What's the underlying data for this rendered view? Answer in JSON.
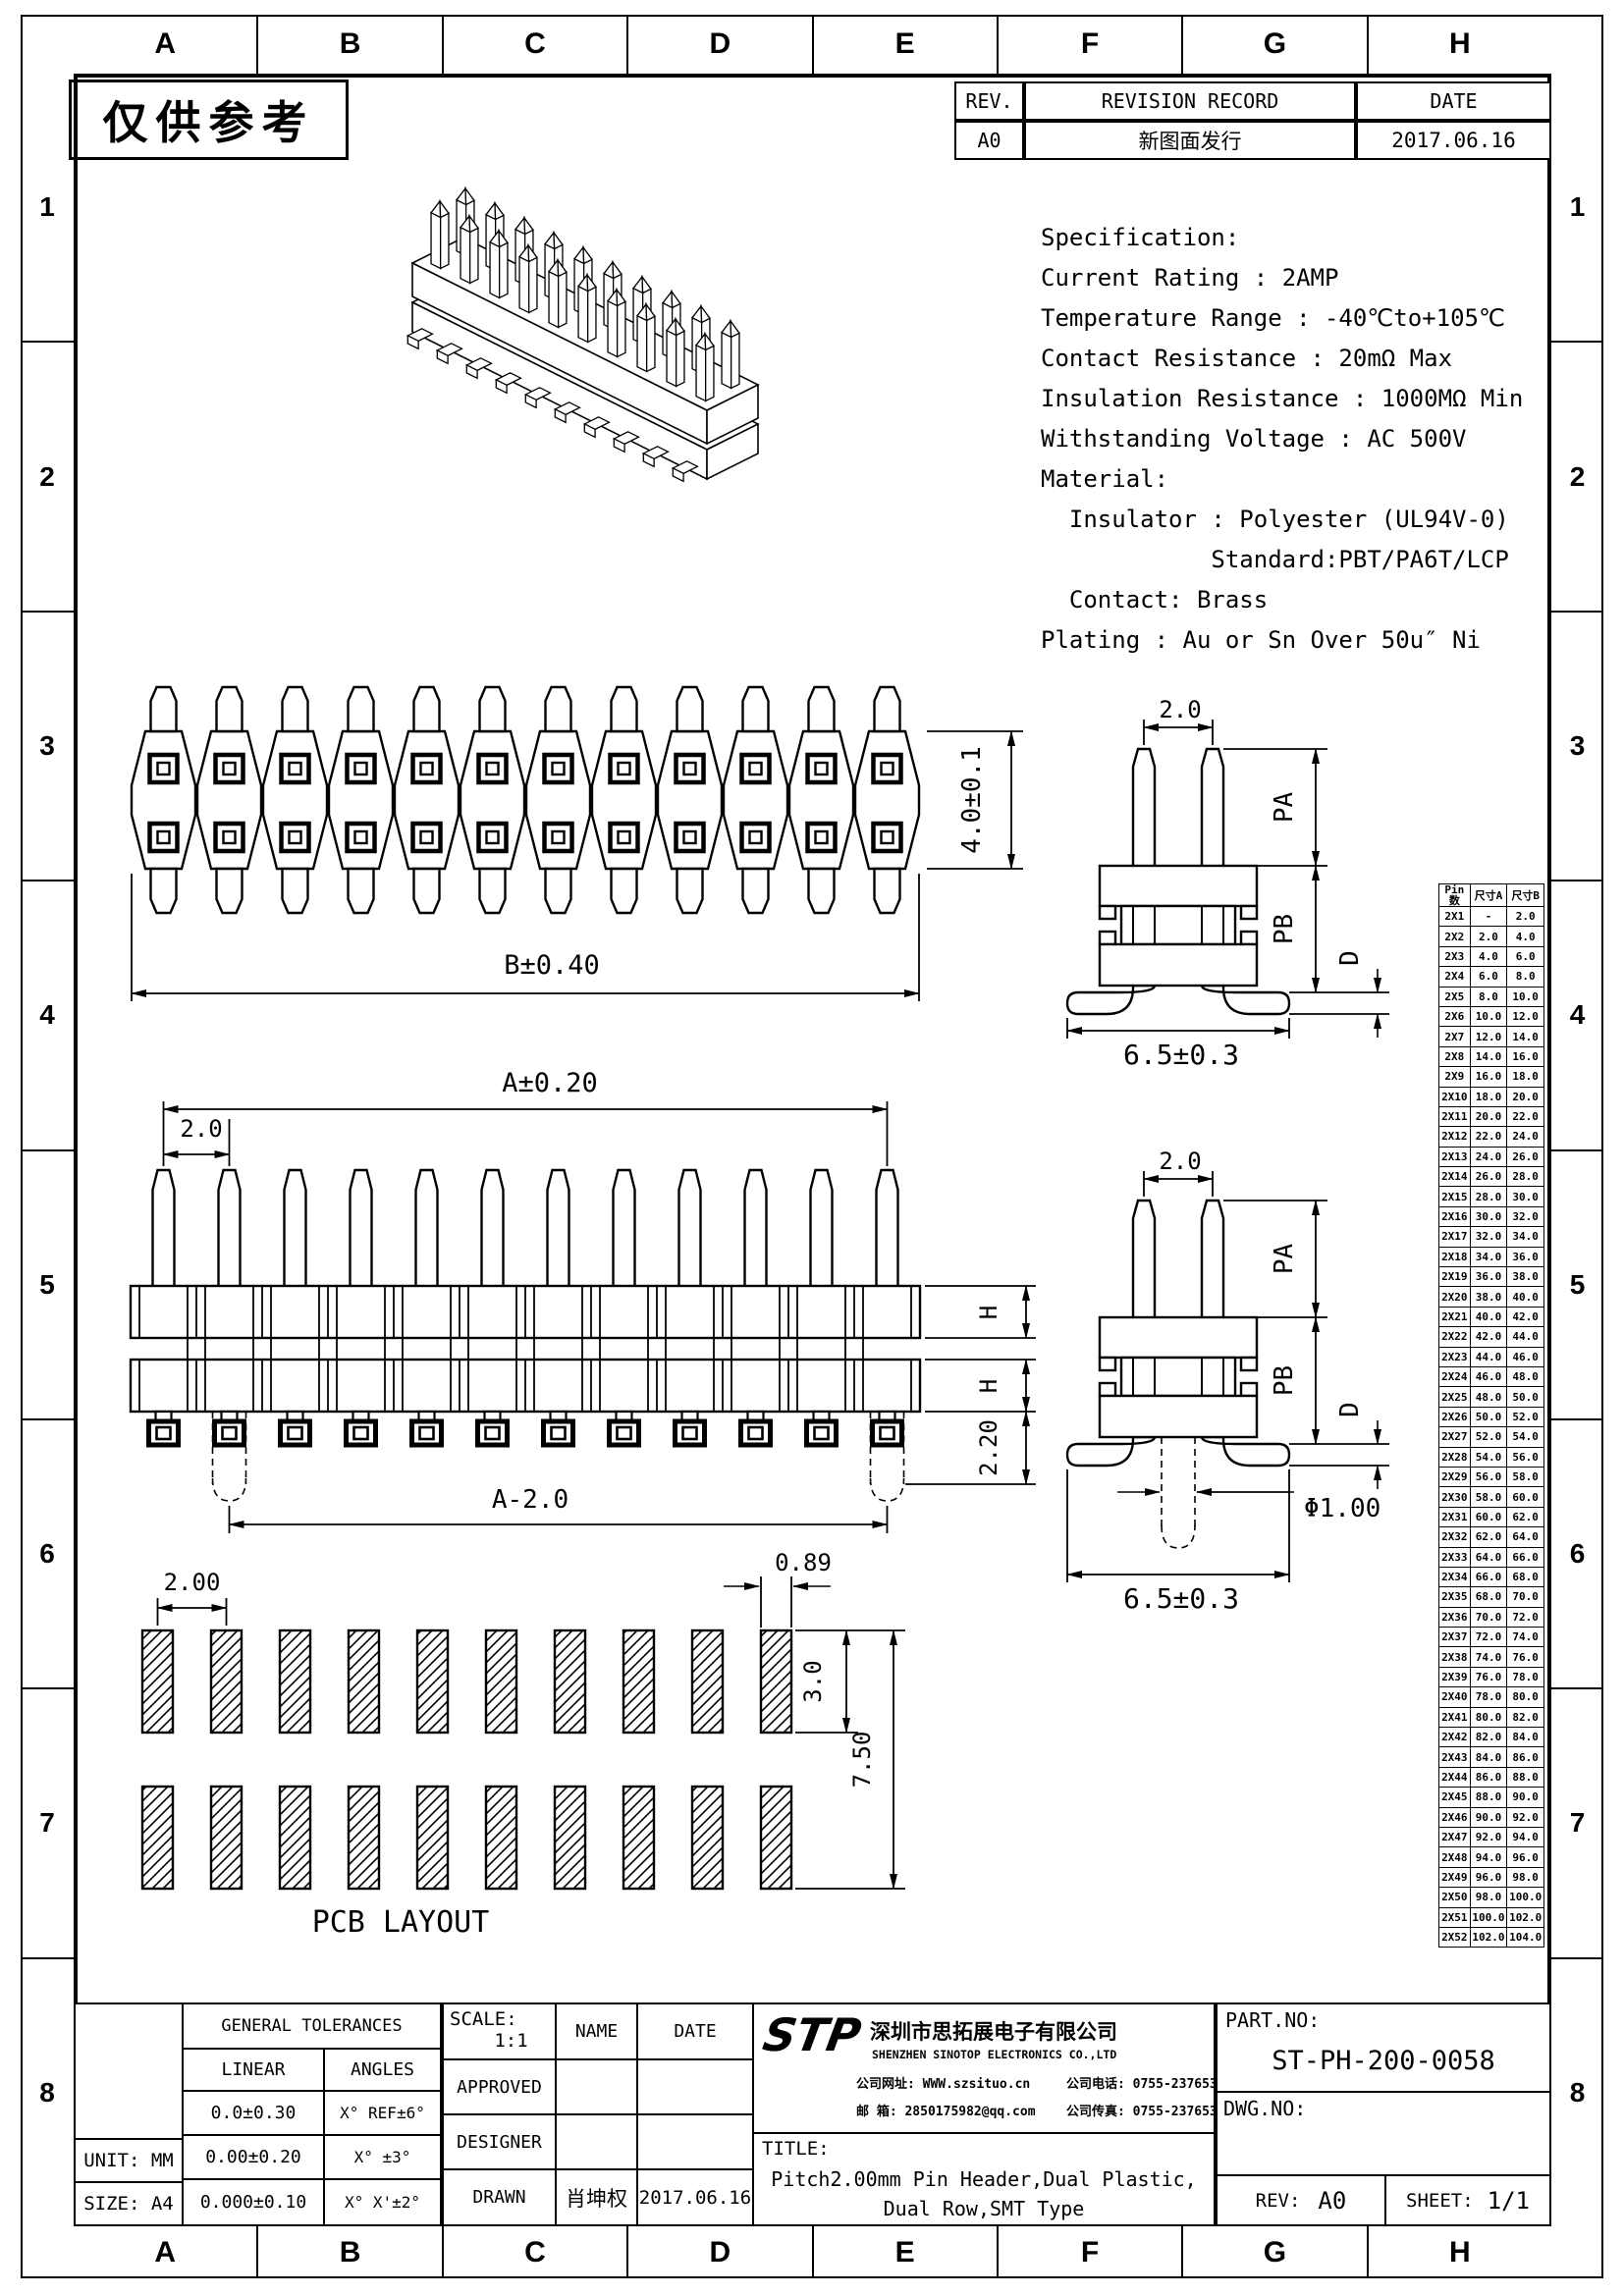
{
  "sheet": {
    "grid_letters": [
      "A",
      "B",
      "C",
      "D",
      "E",
      "F",
      "G",
      "H"
    ],
    "grid_numbers": [
      "1",
      "2",
      "3",
      "4",
      "5",
      "6",
      "7",
      "8"
    ],
    "stamp": "仅供参考"
  },
  "revision_table": {
    "headers": [
      "REV.",
      "REVISION RECORD",
      "DATE"
    ],
    "rows": [
      [
        "A0",
        "新图面发行",
        "2017.06.16"
      ]
    ]
  },
  "specification": {
    "lines": [
      "Specification:",
      "Current Rating : 2AMP",
      "Temperature Range : -40℃to+105℃",
      "Contact Resistance : 20mΩ Max",
      "Insulation Resistance : 1000MΩ Min",
      "Withstanding Voltage : AC 500V",
      "Material:",
      "  Insulator : Polyester (UL94V-0)",
      "            Standard:PBT/PA6T/LCP",
      "  Contact: Brass",
      "Plating : Au or Sn Over 50u″ Ni"
    ]
  },
  "views": {
    "top_view": {
      "pin_columns": 12,
      "dim_length": "B±0.40",
      "dim_height": "4.0±0.1"
    },
    "front_view": {
      "pin_columns": 12,
      "dim_overall": "A±0.20",
      "dim_pitch": "2.0",
      "dim_body_h": "H",
      "dim_foot": "2.20",
      "dim_peg_span": "A-2.0"
    },
    "side_view_upper": {
      "dim_pitch": "2.0",
      "dim_pa": "PA",
      "dim_pb": "PB",
      "dim_d": "D",
      "dim_width": "6.5±0.3"
    },
    "side_view_lower": {
      "dim_pitch": "2.0",
      "dim_pa": "PA",
      "dim_pb": "PB",
      "dim_d": "D",
      "dim_width": "6.5±0.3",
      "dim_peg_dia": "Φ1.00"
    },
    "pcb_layout": {
      "pads_per_row": 10,
      "rows": 2,
      "dim_pitch": "2.00",
      "dim_pad_w": "0.89",
      "dim_pad_h": "3.0",
      "dim_span": "7.50",
      "label": "PCB LAYOUT"
    }
  },
  "size_table": {
    "headers": [
      "Pin数",
      "尺寸A",
      "尺寸B"
    ],
    "rows": [
      [
        "2X1",
        "-",
        "2.0"
      ],
      [
        "2X2",
        "2.0",
        "4.0"
      ],
      [
        "2X3",
        "4.0",
        "6.0"
      ],
      [
        "2X4",
        "6.0",
        "8.0"
      ],
      [
        "2X5",
        "8.0",
        "10.0"
      ],
      [
        "2X6",
        "10.0",
        "12.0"
      ],
      [
        "2X7",
        "12.0",
        "14.0"
      ],
      [
        "2X8",
        "14.0",
        "16.0"
      ],
      [
        "2X9",
        "16.0",
        "18.0"
      ],
      [
        "2X10",
        "18.0",
        "20.0"
      ],
      [
        "2X11",
        "20.0",
        "22.0"
      ],
      [
        "2X12",
        "22.0",
        "24.0"
      ],
      [
        "2X13",
        "24.0",
        "26.0"
      ],
      [
        "2X14",
        "26.0",
        "28.0"
      ],
      [
        "2X15",
        "28.0",
        "30.0"
      ],
      [
        "2X16",
        "30.0",
        "32.0"
      ],
      [
        "2X17",
        "32.0",
        "34.0"
      ],
      [
        "2X18",
        "34.0",
        "36.0"
      ],
      [
        "2X19",
        "36.0",
        "38.0"
      ],
      [
        "2X20",
        "38.0",
        "40.0"
      ],
      [
        "2X21",
        "40.0",
        "42.0"
      ],
      [
        "2X22",
        "42.0",
        "44.0"
      ],
      [
        "2X23",
        "44.0",
        "46.0"
      ],
      [
        "2X24",
        "46.0",
        "48.0"
      ],
      [
        "2X25",
        "48.0",
        "50.0"
      ],
      [
        "2X26",
        "50.0",
        "52.0"
      ],
      [
        "2X27",
        "52.0",
        "54.0"
      ],
      [
        "2X28",
        "54.0",
        "56.0"
      ],
      [
        "2X29",
        "56.0",
        "58.0"
      ],
      [
        "2X30",
        "58.0",
        "60.0"
      ],
      [
        "2X31",
        "60.0",
        "62.0"
      ],
      [
        "2X32",
        "62.0",
        "64.0"
      ],
      [
        "2X33",
        "64.0",
        "66.0"
      ],
      [
        "2X34",
        "66.0",
        "68.0"
      ],
      [
        "2X35",
        "68.0",
        "70.0"
      ],
      [
        "2X36",
        "70.0",
        "72.0"
      ],
      [
        "2X37",
        "72.0",
        "74.0"
      ],
      [
        "2X38",
        "74.0",
        "76.0"
      ],
      [
        "2X39",
        "76.0",
        "78.0"
      ],
      [
        "2X40",
        "78.0",
        "80.0"
      ],
      [
        "2X41",
        "80.0",
        "82.0"
      ],
      [
        "2X42",
        "82.0",
        "84.0"
      ],
      [
        "2X43",
        "84.0",
        "86.0"
      ],
      [
        "2X44",
        "86.0",
        "88.0"
      ],
      [
        "2X45",
        "88.0",
        "90.0"
      ],
      [
        "2X46",
        "90.0",
        "92.0"
      ],
      [
        "2X47",
        "92.0",
        "94.0"
      ],
      [
        "2X48",
        "94.0",
        "96.0"
      ],
      [
        "2X49",
        "96.0",
        "98.0"
      ],
      [
        "2X50",
        "98.0",
        "100.0"
      ],
      [
        "2X51",
        "100.0",
        "102.0"
      ],
      [
        "2X52",
        "102.0",
        "104.0"
      ]
    ]
  },
  "title_block": {
    "general_tolerances": {
      "title": "GENERAL TOLERANCES",
      "col1": "LINEAR",
      "col2": "ANGLES",
      "rows": [
        [
          "0.0±0.30",
          "X° REF±6°"
        ],
        [
          "0.00±0.20",
          "X° ±3°"
        ],
        [
          "0.000±0.10",
          "X° X'±2°"
        ]
      ]
    },
    "unit_label": "UNIT: MM",
    "size_label": "SIZE: A4",
    "scale_label": "SCALE:",
    "scale_value": "1:1",
    "approved_label": "APPROVED",
    "designer_label": "DESIGNER",
    "drawn_label": "DRAWN",
    "name_header": "NAME",
    "date_header": "DATE",
    "drawn_name": "肖坤权",
    "drawn_date": "2017.06.16",
    "company": {
      "logo": "STP",
      "logo_color": "#2493e3",
      "name_cn": "深圳市思拓展电子有限公司",
      "name_en": "SHENZHEN SINOTOP ELECTRONICS CO.,LTD",
      "website_label": "公司网址:",
      "website": "WWW.szsituo.cn",
      "tel_label": "公司电话:",
      "tel": "0755-23765350",
      "email_label": "邮  箱:",
      "email": "2850175982@qq.com",
      "fax_label": "公司传真:",
      "fax": "0755-23765341"
    },
    "title_label": "TITLE:",
    "title_line1": "Pitch2.00mm Pin Header,Dual Plastic,",
    "title_line2": "Dual Row,SMT Type",
    "part_no_label": "PART.NO:",
    "part_no": "ST-PH-200-0058",
    "dwg_no_label": "DWG.NO:",
    "rev_label": "REV:",
    "rev_value": "A0",
    "sheet_label": "SHEET:",
    "sheet_value": "1/1"
  }
}
